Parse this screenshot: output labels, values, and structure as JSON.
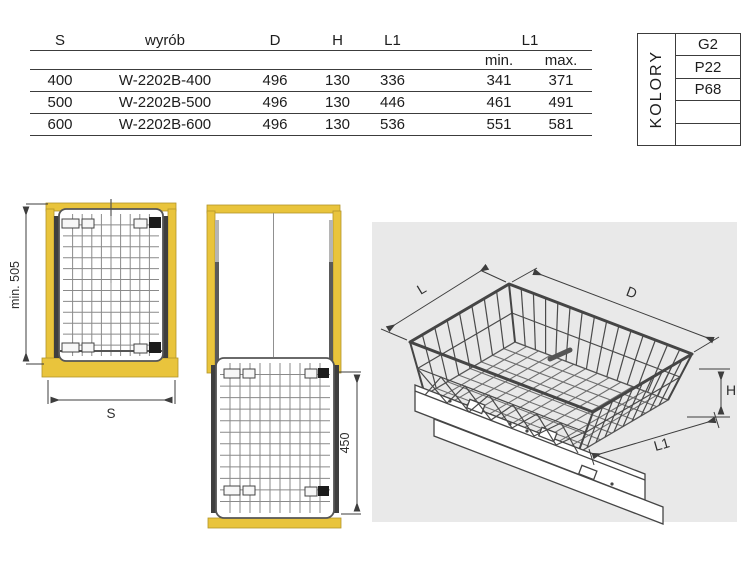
{
  "palette": {
    "accent_yellow": "#E9C43C",
    "yellow_edge": "#B2952A",
    "panel_gray": "#E9E9E9",
    "line_dark": "#3D3D3D",
    "mesh_gray": "#8A8A8A"
  },
  "table": {
    "col_s": "S",
    "col_product": "wyrób",
    "col_d": "D",
    "col_h": "H",
    "col_l1": "L1",
    "col_l1_range": "L1",
    "col_min": "min.",
    "col_max": "max.",
    "rows": [
      {
        "s": "400",
        "product": "W-2202B-400",
        "d": "496",
        "h": "130",
        "l1": "336",
        "l1_min": "341",
        "l1_max": "371"
      },
      {
        "s": "500",
        "product": "W-2202B-500",
        "d": "496",
        "h": "130",
        "l1": "446",
        "l1_min": "461",
        "l1_max": "491"
      },
      {
        "s": "600",
        "product": "W-2202B-600",
        "d": "496",
        "h": "130",
        "l1": "536",
        "l1_min": "551",
        "l1_max": "581"
      }
    ]
  },
  "colors_box": {
    "label": "KOLORY",
    "options": [
      "G2",
      "P22",
      "P68",
      "",
      ""
    ]
  },
  "drawings": {
    "front_view": {
      "depth_dim": "min. 505",
      "width_dim": "S"
    },
    "top_view": {
      "extension_dim": "450"
    },
    "iso_view": {
      "width_dim": "L",
      "depth_dim": "D",
      "height_dim": "H",
      "slide_dim": "L1"
    }
  }
}
